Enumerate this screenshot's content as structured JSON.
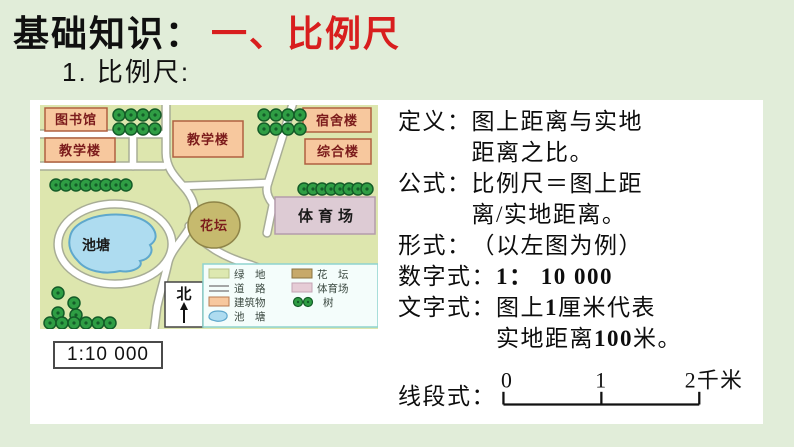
{
  "title": {
    "prefix": "基础知识：",
    "highlight": "一、比例尺"
  },
  "subtitle": "1. 比例尺:",
  "colors": {
    "accent_red": "#d81e1e",
    "page_bg": "#e1edd9",
    "map_bg": "#dde6ae",
    "building_fill": "#f7c89e",
    "stadium_fill": "#ddcbd4",
    "pond_fill": "#aedcf0",
    "flowerbed_fill": "#c6ba6e",
    "tree_green": "#2f9e44"
  },
  "map": {
    "buildings": {
      "library": "图书馆",
      "teaching_left": "教学楼",
      "teaching_center": "教学楼",
      "dorm": "宿舍楼",
      "complex": "综合楼",
      "stadium": "体育场",
      "flowerbed": "花坛",
      "pond": "池塘"
    },
    "north_label": "北",
    "legend": {
      "items": [
        {
          "label": "绿　地"
        },
        {
          "label": "道　路"
        },
        {
          "label": "建筑物"
        },
        {
          "label": "池　塘"
        },
        {
          "label": "花　坛"
        },
        {
          "label": "体育场"
        },
        {
          "label": "树"
        }
      ]
    },
    "scale_text": "1:10 000"
  },
  "definitions": {
    "rows": [
      {
        "label": "定义：",
        "line1": "图上距离与实地",
        "line2": "距离之比。"
      },
      {
        "label": "公式：",
        "line1": "比例尺＝图上距",
        "line2": "离/实地距离。"
      },
      {
        "label": "形式：",
        "line1": "（以左图为例）"
      },
      {
        "label": "数字式：",
        "value": "1： 10 000"
      },
      {
        "label": "文字式：",
        "line1_pre": "图上",
        "line1_num": "1",
        "line1_post": "厘米代表",
        "line2_pre": "实地距离",
        "line2_num": "100",
        "line2_post": "米。"
      },
      {
        "label": "线段式："
      }
    ]
  },
  "scalebar": {
    "tick0": "0",
    "tick1": "1",
    "tick2": "2千米"
  }
}
